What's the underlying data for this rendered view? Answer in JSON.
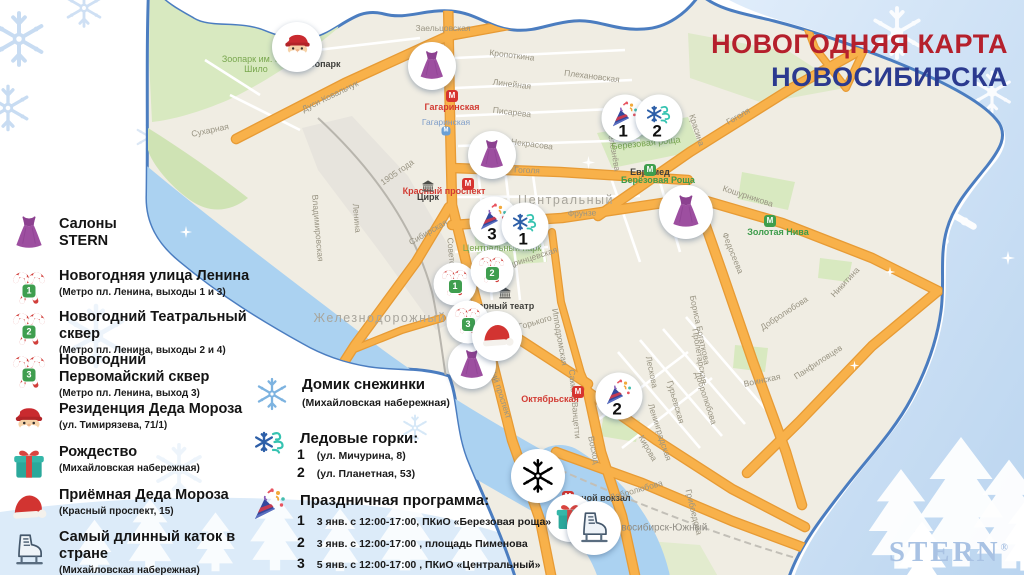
{
  "title": {
    "line1": "НОВОГОДНЯЯ КАРТА",
    "line2": "НОВОСИБИРСКА",
    "color1": "#b5202c",
    "color2": "#2b3a8f"
  },
  "logo": {
    "text": "STERN",
    "reg": "®"
  },
  "legend": {
    "items": [
      {
        "icon": "dress-icon",
        "line1": "Салоны",
        "line2": "STERN",
        "sub": "",
        "badge": ""
      },
      {
        "icon": "candy-canes-icon",
        "line1": "Новогодняя улица Ленина",
        "line2": "",
        "sub": "(Метро пл. Ленина, выходы 1 и 3)",
        "badge": "1"
      },
      {
        "icon": "candy-canes-icon",
        "line1": "Новогодний Театральный сквер",
        "line2": "",
        "sub": "(Метро пл. Ленина, выходы 2 и 4)",
        "badge": "2"
      },
      {
        "icon": "candy-canes-icon",
        "line1": "Новогодний",
        "line2": "Первомайский сквер",
        "sub": "(Метро пл. Ленина, выход 3)",
        "badge": "3"
      },
      {
        "icon": "santa-icon",
        "line1": "Резиденция Деда Мороза",
        "line2": "",
        "sub": "(ул. Тимирязева, 71/1)",
        "badge": ""
      },
      {
        "icon": "gift-icon",
        "line1": "Рождество",
        "line2": "",
        "sub": "(Михайловская набережная)",
        "badge": ""
      },
      {
        "icon": "santa-hat-icon",
        "line1": "Приёмная Деда Мороза",
        "line2": "",
        "sub": "(Красный проспект, 15)",
        "badge": ""
      },
      {
        "icon": "ice-skate-icon",
        "line1": "Самый длинный каток в стране",
        "line2": "",
        "sub": "(Михайловская набережная)",
        "badge": ""
      }
    ]
  },
  "legend2": {
    "sections": [
      {
        "icon": "snowflake-icon",
        "title": "Домик снежинки",
        "sub": "(Михайловская набережная)"
      },
      {
        "icon": "ice-slides-icon",
        "title": "Ледовые горки:",
        "entries": [
          {
            "num": "1",
            "text": "(ул. Мичурина,  8)"
          },
          {
            "num": "2",
            "text": "(ул. Планетная,  53)"
          }
        ]
      },
      {
        "icon": "party-popper-icon",
        "title": "Праздничная программа:",
        "entries": [
          {
            "num": "1",
            "text": "3 янв. с 12:00-17:00,  ПКиО «Березовая роща»"
          },
          {
            "num": "2",
            "text": "3 янв. с 12:00-17:00 ,  площадь  Пименова"
          },
          {
            "num": "3",
            "text": "5 янв. с 12:00-17:00 ,  ПКиО «Центральный»"
          }
        ]
      }
    ]
  },
  "map": {
    "metro_letter": "М",
    "districts_note": "rendered from labels[]",
    "labels": [
      {
        "t": "Заельцовская",
        "x": 443,
        "y": 28,
        "r": 0,
        "c": "street"
      },
      {
        "t": "Зоопарк им. Р.А. Шило",
        "x": 256,
        "y": 64,
        "r": 0,
        "c": "park",
        "w": 80
      },
      {
        "t": "Зоопарк",
        "x": 322,
        "y": 64,
        "r": 0,
        "c": "poi"
      },
      {
        "t": "Дуси Ковальчук",
        "x": 330,
        "y": 96,
        "r": -26,
        "c": "street"
      },
      {
        "t": "Сухарная",
        "x": 210,
        "y": 130,
        "r": -12,
        "c": "street"
      },
      {
        "t": "Кропоткина",
        "x": 512,
        "y": 55,
        "r": 7,
        "c": "street"
      },
      {
        "t": "Линейная",
        "x": 512,
        "y": 84,
        "r": 7,
        "c": "street"
      },
      {
        "t": "Плехановская",
        "x": 592,
        "y": 76,
        "r": 7,
        "c": "street"
      },
      {
        "t": "Гагаринская",
        "x": 452,
        "y": 107,
        "r": 0,
        "c": "metro-red"
      },
      {
        "t": "Гагаринская",
        "x": 446,
        "y": 122,
        "r": 0,
        "c": "station"
      },
      {
        "t": "Писарева",
        "x": 512,
        "y": 112,
        "r": 7,
        "c": "street"
      },
      {
        "t": "Некрасова",
        "x": 532,
        "y": 144,
        "r": 7,
        "c": "street"
      },
      {
        "t": "Гоголя",
        "x": 527,
        "y": 170,
        "r": 2,
        "c": "street"
      },
      {
        "t": "Евромед",
        "x": 650,
        "y": 172,
        "r": 0,
        "c": "poi"
      },
      {
        "t": "Селезнёва",
        "x": 614,
        "y": 150,
        "r": 80,
        "c": "street"
      },
      {
        "t": "Красина",
        "x": 697,
        "y": 130,
        "r": 72,
        "c": "street"
      },
      {
        "t": "Гоголя",
        "x": 738,
        "y": 116,
        "r": -30,
        "c": "street"
      },
      {
        "t": "Березовая роща",
        "x": 646,
        "y": 143,
        "r": -6,
        "c": "park"
      },
      {
        "t": "Берёзовая Роща",
        "x": 658,
        "y": 180,
        "r": 0,
        "c": "metro-green"
      },
      {
        "t": "Красный проспект",
        "x": 444,
        "y": 191,
        "r": 0,
        "c": "metro-red"
      },
      {
        "t": "Цирк",
        "x": 428,
        "y": 197,
        "r": 0,
        "c": "poi"
      },
      {
        "t": "Центральный",
        "x": 566,
        "y": 200,
        "r": 0,
        "c": "district"
      },
      {
        "t": "Железнодорожный",
        "x": 380,
        "y": 318,
        "r": 0,
        "c": "district"
      },
      {
        "t": "Фрунзе",
        "x": 582,
        "y": 213,
        "r": -2,
        "c": "street"
      },
      {
        "t": "Центральный парк",
        "x": 502,
        "y": 248,
        "r": 0,
        "c": "park"
      },
      {
        "t": "Ядринцевская",
        "x": 530,
        "y": 258,
        "r": -18,
        "c": "street"
      },
      {
        "t": "Советская",
        "x": 452,
        "y": 258,
        "r": 85,
        "c": "street"
      },
      {
        "t": "Ленина",
        "x": 357,
        "y": 218,
        "r": 85,
        "c": "street"
      },
      {
        "t": "1905 года",
        "x": 397,
        "y": 172,
        "r": -35,
        "c": "street"
      },
      {
        "t": "Сибирская",
        "x": 428,
        "y": 232,
        "r": -30,
        "c": "street"
      },
      {
        "t": "Владимировская",
        "x": 318,
        "y": 228,
        "r": 85,
        "c": "street"
      },
      {
        "t": "Кошурникова",
        "x": 748,
        "y": 196,
        "r": 18,
        "c": "street"
      },
      {
        "t": "Золотая Нива",
        "x": 778,
        "y": 232,
        "r": 0,
        "c": "metro-green"
      },
      {
        "t": "Федосеева",
        "x": 733,
        "y": 253,
        "r": 68,
        "c": "street"
      },
      {
        "t": "Оперный театр",
        "x": 500,
        "y": 306,
        "r": 0,
        "c": "poi"
      },
      {
        "t": "Горького",
        "x": 535,
        "y": 322,
        "r": -16,
        "c": "street"
      },
      {
        "t": "Ипподромская",
        "x": 560,
        "y": 337,
        "r": 80,
        "c": "street"
      },
      {
        "t": "Красный проспект",
        "x": 498,
        "y": 384,
        "r": 72,
        "c": "street"
      },
      {
        "t": "Бориса Богаткова",
        "x": 700,
        "y": 330,
        "r": 78,
        "c": "street"
      },
      {
        "t": "Добролюбова",
        "x": 784,
        "y": 313,
        "r": -33,
        "c": "street"
      },
      {
        "t": "Никитина",
        "x": 845,
        "y": 282,
        "r": -47,
        "c": "street"
      },
      {
        "t": "Панфиловцев",
        "x": 818,
        "y": 362,
        "r": -33,
        "c": "street"
      },
      {
        "t": "Воинская",
        "x": 762,
        "y": 380,
        "r": -12,
        "c": "street"
      },
      {
        "t": "Пролетарская",
        "x": 700,
        "y": 356,
        "r": 80,
        "c": "street"
      },
      {
        "t": "Лескова",
        "x": 652,
        "y": 372,
        "r": 78,
        "c": "street"
      },
      {
        "t": "Добролюбова",
        "x": 706,
        "y": 398,
        "r": 72,
        "c": "street"
      },
      {
        "t": "Гурьевская",
        "x": 676,
        "y": 402,
        "r": 74,
        "c": "street"
      },
      {
        "t": "Ленинградская",
        "x": 660,
        "y": 432,
        "r": 72,
        "c": "street"
      },
      {
        "t": "Кирова",
        "x": 648,
        "y": 448,
        "r": 60,
        "c": "street"
      },
      {
        "t": "Сакко и Ванцетти",
        "x": 575,
        "y": 404,
        "r": 85,
        "c": "street"
      },
      {
        "t": "Восход",
        "x": 594,
        "y": 450,
        "r": 78,
        "c": "street"
      },
      {
        "t": "Октябрьская",
        "x": 550,
        "y": 399,
        "r": 0,
        "c": "metro-red"
      },
      {
        "t": "Речной вокзал",
        "x": 598,
        "y": 498,
        "r": 0,
        "c": "poi"
      },
      {
        "t": "Добролюбова",
        "x": 636,
        "y": 490,
        "r": -16,
        "c": "street"
      },
      {
        "t": "Грибоедова",
        "x": 694,
        "y": 512,
        "r": 76,
        "c": "street"
      },
      {
        "t": "Новосибирск-Южный",
        "x": 658,
        "y": 528,
        "r": 0,
        "c": "district2"
      }
    ],
    "metro_icons": [
      {
        "x": 452,
        "y": 96,
        "line": "red"
      },
      {
        "x": 468,
        "y": 184,
        "line": "red"
      },
      {
        "x": 463,
        "y": 295,
        "line": "red"
      },
      {
        "x": 650,
        "y": 170,
        "line": "green"
      },
      {
        "x": 770,
        "y": 221,
        "line": "green"
      },
      {
        "x": 578,
        "y": 392,
        "line": "red"
      },
      {
        "x": 568,
        "y": 497,
        "line": "red"
      },
      {
        "x": 446,
        "y": 131,
        "line": "blue"
      }
    ],
    "poi_icons": [
      {
        "icon": "bear",
        "x": 314,
        "y": 52
      },
      {
        "icon": "theater",
        "x": 505,
        "y": 293
      },
      {
        "icon": "theater",
        "x": 428,
        "y": 186
      }
    ],
    "markers": [
      {
        "icon": "santa",
        "x": 297,
        "y": 47,
        "s": 50
      },
      {
        "icon": "dress",
        "x": 432,
        "y": 66,
        "s": 48
      },
      {
        "icon": "dress",
        "x": 492,
        "y": 155,
        "s": 48
      },
      {
        "icon": "dress",
        "x": 686,
        "y": 212,
        "s": 54
      },
      {
        "icon": "dress",
        "x": 472,
        "y": 365,
        "s": 48
      },
      {
        "icon": "party",
        "x": 625,
        "y": 118,
        "s": 47,
        "num": "1"
      },
      {
        "icon": "icewind",
        "x": 659,
        "y": 118,
        "s": 47,
        "num": "2"
      },
      {
        "icon": "party",
        "x": 494,
        "y": 221,
        "s": 49,
        "num": "3"
      },
      {
        "icon": "icewind",
        "x": 525,
        "y": 226,
        "s": 47,
        "num": "1"
      },
      {
        "icon": "candy",
        "x": 455,
        "y": 284,
        "s": 43,
        "badge": "1"
      },
      {
        "icon": "candy",
        "x": 492,
        "y": 271,
        "s": 43,
        "badge": "2"
      },
      {
        "icon": "candy",
        "x": 468,
        "y": 322,
        "s": 43,
        "badge": "3"
      },
      {
        "icon": "santahat",
        "x": 497,
        "y": 336,
        "s": 50
      },
      {
        "icon": "party",
        "x": 619,
        "y": 396,
        "s": 47,
        "num": "2"
      },
      {
        "icon": "snowflake",
        "x": 538,
        "y": 476,
        "s": 54
      },
      {
        "icon": "gift",
        "x": 570,
        "y": 518,
        "s": 48
      },
      {
        "icon": "skate",
        "x": 594,
        "y": 528,
        "s": 54
      }
    ]
  }
}
